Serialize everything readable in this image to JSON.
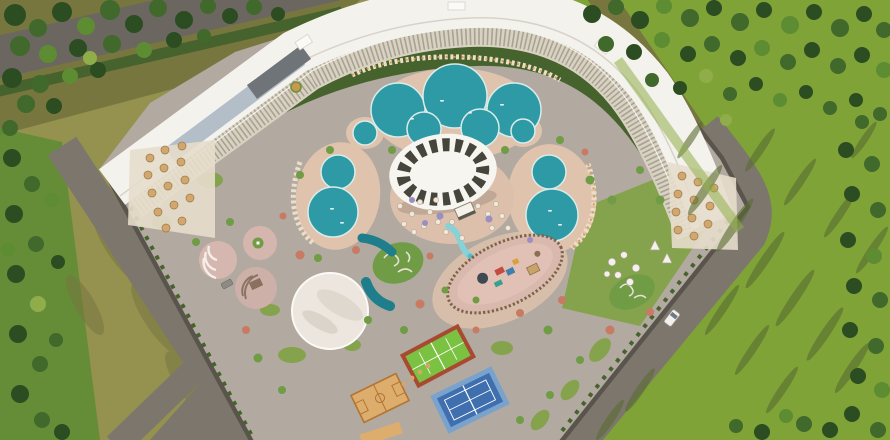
{
  "meta": {
    "type": "aerial-3d-architectural-render",
    "subject": "Bird's-eye view of a curved resort/apartment complex with pools, sports courts and surrounding forest",
    "width_px": 890,
    "height_px": 440,
    "visible_text": ""
  },
  "palette": {
    "olive_field": "#95914f",
    "olive_dark": "#77763f",
    "grass_east": "#7fa337",
    "grass_inner": "#85a24c",
    "forest_dark": "#2c4d21",
    "forest_mid": "#40692b",
    "forest_bright": "#5d8c33",
    "forest_yellow": "#8fae4a",
    "road": "#7c766d",
    "road_dark": "#6b6760",
    "path_gray": "#b2a9a0",
    "deck_pink": "#e0c3ad",
    "plaza_pink": "#dcc0ac",
    "pool_teal": "#2e9aa6",
    "pool_deep": "#1f7e8b",
    "pool_light": "#6cc8cd",
    "roof_white": "#f4f2ed",
    "facade": "#d9d2c2",
    "facade_line": "#7f7a6b",
    "skylight": "#b3bec9",
    "wall": "#59544c",
    "cabana": "#d2a76f",
    "court_sand": "#ddad6e",
    "court_sand_line": "#b5742f",
    "court_green": "#7cc242",
    "court_green_border": "#a84a32",
    "court_blue": "#79a3cc",
    "court_blue_inner": "#3f6fae",
    "canopy_dark": "#45453c",
    "event_white": "#ece6df",
    "shadow_streak": "#5a6d31",
    "hedge": "#47632d",
    "flower_coral": "#c87a62",
    "flower_lavender": "#9a8fc0",
    "bush_green": "#6f9c44",
    "car_white": "#f2f1ee",
    "car_gray": "#8f8b84"
  },
  "scene": {
    "landmarks": [
      {
        "id": "curved-apartment-building",
        "label": "long curved white-roofed residence block wrapping the north and east of the plot"
      },
      {
        "id": "rooftop-skylight",
        "label": "blue-gray glass strip on the west wing roof"
      },
      {
        "id": "left-terrace-cabanas",
        "label": "stepped terraces with tan umbrellas at the west end of the building"
      },
      {
        "id": "right-terrace-cabanas",
        "label": "stepped terraces with tan umbrellas at the east end of the building"
      },
      {
        "id": "lagoon-pool",
        "label": "large multi-lobed lagoon pool at top center"
      },
      {
        "id": "round-pool-west",
        "label": "small round pool west of the lagoon"
      },
      {
        "id": "round-pool-east",
        "label": "small round pool east of the lagoon"
      },
      {
        "id": "figure8-pool-west",
        "label": "figure-eight pool on the west side"
      },
      {
        "id": "figure8-pool-east",
        "label": "figure-eight pool on the east side"
      },
      {
        "id": "central-canopy-pavilion",
        "label": "white elliptical canopy with radial dark ribs"
      },
      {
        "id": "umbrella-plaza",
        "label": "beach-bar plaza with many small umbrellas"
      },
      {
        "id": "kids-playground",
        "label": "fenced bean-shaped playground"
      },
      {
        "id": "water-slides",
        "label": "winding lazy-river / slide ribbons"
      },
      {
        "id": "event-dome-plaza",
        "label": "large white circular event plaza"
      },
      {
        "id": "amphitheater",
        "label": "round amphitheater with white benches"
      },
      {
        "id": "stage-circle",
        "label": "round stage plaza with steps"
      },
      {
        "id": "basketball-court",
        "label": "sand-colored basketball court"
      },
      {
        "id": "padel-court",
        "label": "green court with red-brown border"
      },
      {
        "id": "tennis-court",
        "label": "blue tennis court"
      },
      {
        "id": "glamping-domes",
        "label": "cluster of white garden domes"
      },
      {
        "id": "teepee-tents",
        "label": "two white teepee tents"
      },
      {
        "id": "white-van",
        "label": "white van on the southeast road"
      },
      {
        "id": "parked-car",
        "label": "gray car parked near the stage"
      },
      {
        "id": "forest-northwest",
        "label": "dense forest in the top-left corner"
      },
      {
        "id": "forest-east",
        "label": "pine forest on the right side"
      },
      {
        "id": "meadow-southwest",
        "label": "olive open field at lower left"
      },
      {
        "id": "roads",
        "label": "gray perimeter roads with Y junction at lower left and diagonal road at lower right"
      }
    ]
  }
}
